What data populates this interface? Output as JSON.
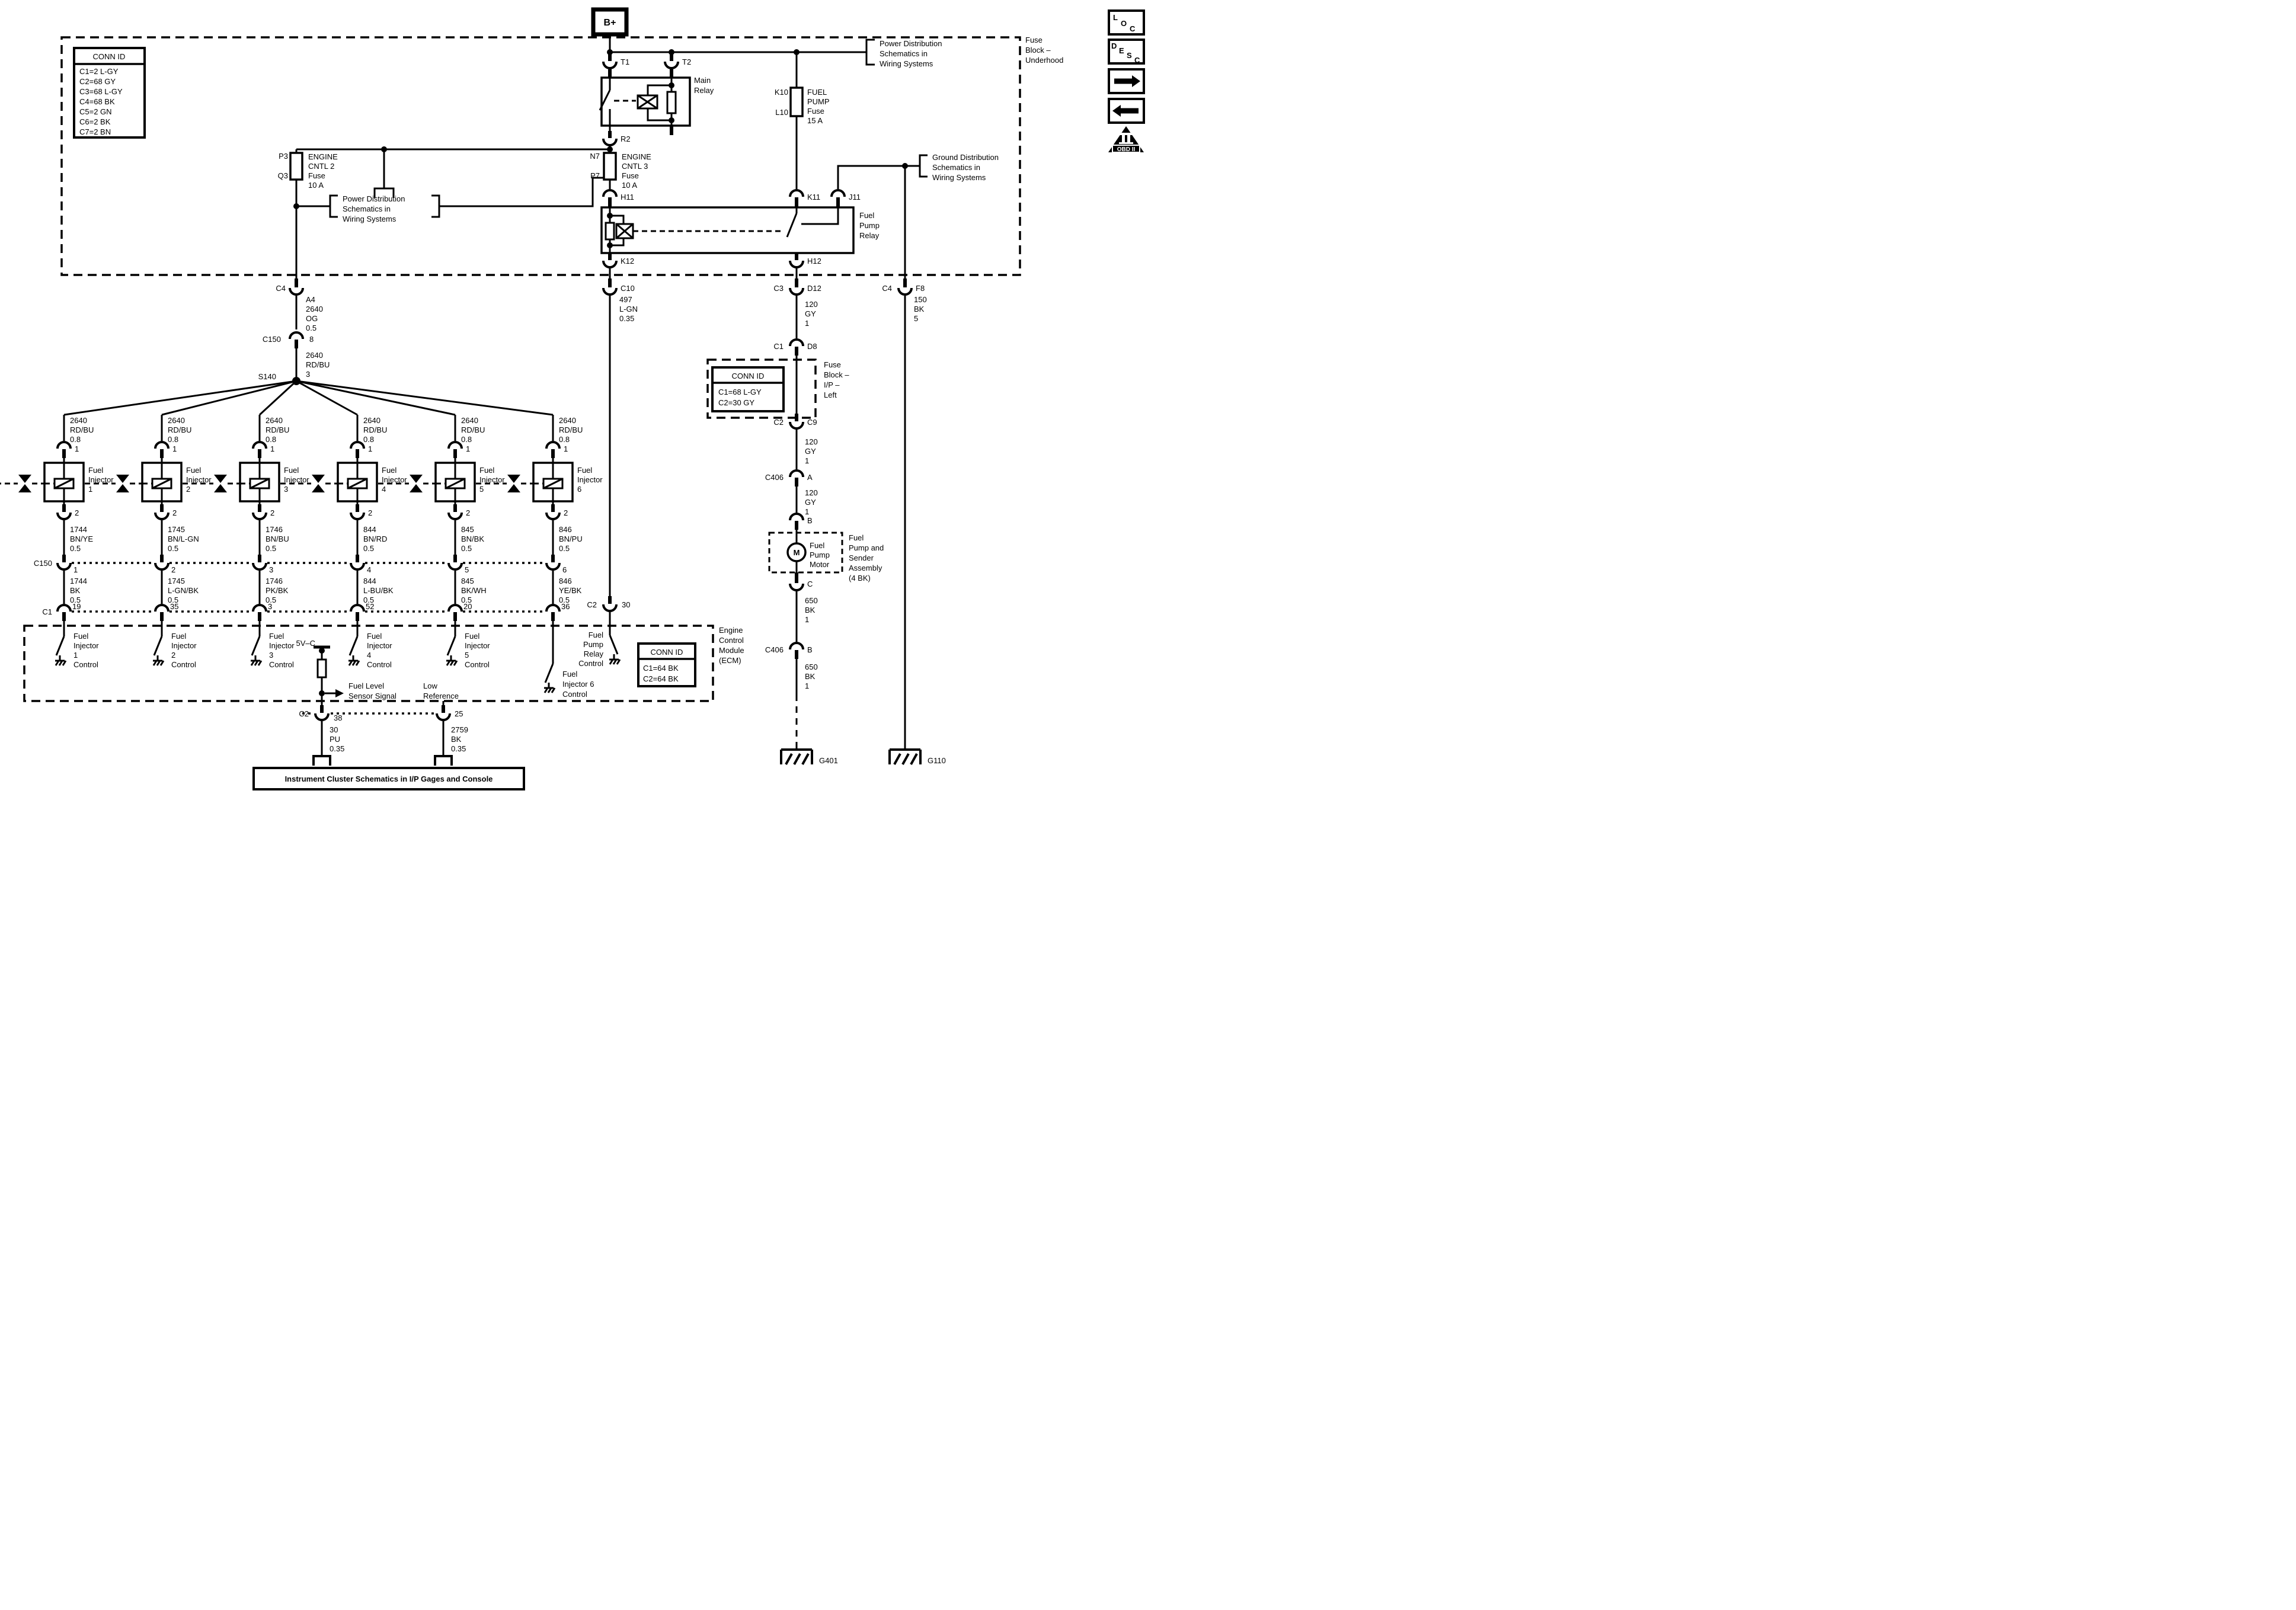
{
  "b_plus": "B+",
  "fuse_block_underhood": {
    "label_lines": [
      "Fuse",
      "Block –",
      "Underhood"
    ],
    "conn_id": {
      "title": "CONN ID",
      "rows": [
        "C1=2 L-GY",
        "C2=68 GY",
        "C3=68 L-GY",
        "C4=68 BK",
        "C5=2 GN",
        "C6=2 BK",
        "C7=2 BN"
      ]
    }
  },
  "links": {
    "power_dist_top": [
      "Power Distribution",
      "Schematics in",
      "Wiring Systems"
    ],
    "power_dist_mid": [
      "Power Distribution",
      "Schematics in",
      "Wiring Systems"
    ],
    "ground_dist": [
      "Ground Distribution",
      "Schematics in",
      "Wiring Systems"
    ],
    "instrument_cluster": "Instrument Cluster Schematics in I/P Gages and Console"
  },
  "main_relay": {
    "name_lines": [
      "Main",
      "Relay"
    ],
    "t1": "T1",
    "t2": "T2",
    "r2": "R2"
  },
  "fuses": {
    "engine_cntl_2": {
      "pin_top": "P3",
      "pin_bottom": "Q3",
      "label_lines": [
        "ENGINE",
        "CNTL 2",
        "Fuse",
        "10 A"
      ]
    },
    "engine_cntl_3": {
      "pin_top": "N7",
      "pin_bottom": "P7",
      "label_lines": [
        "ENGINE",
        "CNTL 3",
        "Fuse",
        "10 A"
      ]
    },
    "fuel_pump": {
      "pin_top": "K10",
      "pin_bottom": "L10",
      "label_lines": [
        "FUEL",
        "PUMP",
        "Fuse",
        "15 A"
      ]
    }
  },
  "fuel_pump_relay": {
    "name_lines": [
      "Fuel",
      "Pump",
      "Relay"
    ],
    "h11": "H11",
    "k11": "K11",
    "j11": "J11",
    "k12": "K12",
    "h12": "H12"
  },
  "connectors": {
    "c4_left": "C4",
    "c10": "C10",
    "c3": "C3",
    "d12": "D12",
    "c4_right": "C4",
    "f8": "F8",
    "c150_main": {
      "name": "C150",
      "pin": "8"
    },
    "s140": "S140",
    "c150_row": "C150",
    "c1_row": "C1",
    "c2_30": {
      "left": "C2",
      "right": "30"
    },
    "c2_38": {
      "left": "C2",
      "right": "38"
    },
    "pin_25": "25",
    "c1_d8": {
      "left": "C1",
      "right": "D8"
    },
    "c2_c9": {
      "left": "C2",
      "right": "C9"
    },
    "c406_a": {
      "left": "C406",
      "right": "A"
    },
    "pin_b_upper": "B",
    "pin_c": "C",
    "c406_b": {
      "left": "C406",
      "right": "B"
    }
  },
  "wires": {
    "a4_feed": [
      "A4",
      "2640",
      "OG",
      "0.5"
    ],
    "s140_feed": [
      "2640",
      "RD/BU",
      "3"
    ],
    "relay_control": [
      "497",
      "L-GN",
      "0.35"
    ],
    "pump_feed_1": [
      "120",
      "GY",
      "1"
    ],
    "pump_feed_2": [
      "120",
      "GY",
      "1"
    ],
    "pump_feed_3": [
      "120",
      "GY",
      "1"
    ],
    "right_ground": [
      "150",
      "BK",
      "5"
    ],
    "pump_ground_1": [
      "650",
      "BK",
      "1"
    ],
    "pump_ground_2": [
      "650",
      "BK",
      "1"
    ],
    "sensor_signal": [
      "30",
      "PU",
      "0.35"
    ],
    "low_ref_wire": [
      "2759",
      "BK",
      "0.35"
    ]
  },
  "injectors": [
    {
      "feed": [
        "2640",
        "RD/BU",
        "0.8"
      ],
      "pin_top": "1",
      "name": [
        "Fuel",
        "Injector",
        "1"
      ],
      "pin_bottom": "2",
      "out": [
        "1744",
        "BN/YE",
        "0.5"
      ],
      "c150_pin": "1",
      "below": [
        "1744",
        "BK",
        "0.5"
      ],
      "ecm_pin": "19"
    },
    {
      "feed": [
        "2640",
        "RD/BU",
        "0.8"
      ],
      "pin_top": "1",
      "name": [
        "Fuel",
        "Injector",
        "2"
      ],
      "pin_bottom": "2",
      "out": [
        "1745",
        "BN/L-GN",
        "0.5"
      ],
      "c150_pin": "2",
      "below": [
        "1745",
        "L-GN/BK",
        "0.5"
      ],
      "ecm_pin": "35"
    },
    {
      "feed": [
        "2640",
        "RD/BU",
        "0.8"
      ],
      "pin_top": "1",
      "name": [
        "Fuel",
        "Injector",
        "3"
      ],
      "pin_bottom": "2",
      "out": [
        "1746",
        "BN/BU",
        "0.5"
      ],
      "c150_pin": "3",
      "below": [
        "1746",
        "PK/BK",
        "0.5"
      ],
      "ecm_pin": "3"
    },
    {
      "feed": [
        "2640",
        "RD/BU",
        "0.8"
      ],
      "pin_top": "1",
      "name": [
        "Fuel",
        "Injector",
        "4"
      ],
      "pin_bottom": "2",
      "out": [
        "844",
        "BN/RD",
        "0.5"
      ],
      "c150_pin": "4",
      "below": [
        "844",
        "L-BU/BK",
        "0.5"
      ],
      "ecm_pin": "52"
    },
    {
      "feed": [
        "2640",
        "RD/BU",
        "0.8"
      ],
      "pin_top": "1",
      "name": [
        "Fuel",
        "Injector",
        "5"
      ],
      "pin_bottom": "2",
      "out": [
        "845",
        "BN/BK",
        "0.5"
      ],
      "c150_pin": "5",
      "below": [
        "845",
        "BK/WH",
        "0.5"
      ],
      "ecm_pin": "20"
    },
    {
      "feed": [
        "2640",
        "RD/BU",
        "0.8"
      ],
      "pin_top": "1",
      "name": [
        "Fuel",
        "Injector",
        "6"
      ],
      "pin_bottom": "2",
      "out": [
        "846",
        "BN/PU",
        "0.5"
      ],
      "c150_pin": "6",
      "below": [
        "846",
        "YE/BK",
        "0.5"
      ],
      "ecm_pin": "36"
    }
  ],
  "controls": [
    {
      "lines": [
        "Fuel",
        "Injector",
        "1",
        "Control"
      ]
    },
    {
      "lines": [
        "Fuel",
        "Injector",
        "2",
        "Control"
      ]
    },
    {
      "lines": [
        "Fuel",
        "Injector",
        "3",
        "Control"
      ]
    },
    {
      "lines": [
        "Fuel",
        "Injector",
        "4",
        "Control"
      ]
    },
    {
      "lines": [
        "Fuel",
        "Injector",
        "5",
        "Control"
      ]
    }
  ],
  "ecm": {
    "name_lines": [
      "Engine",
      "Control",
      "Module",
      "(ECM)"
    ],
    "conn_id": {
      "title": "CONN ID",
      "rows": [
        "C1=64 BK",
        "C2=64 BK"
      ]
    },
    "five_v": "5V–C",
    "fuel_level": [
      "Fuel Level",
      "Sensor Signal"
    ],
    "low_reference": [
      "Low",
      "Reference"
    ],
    "pump_relay_control": [
      "Fuel",
      "Pump",
      "Relay",
      "Control"
    ],
    "inj6_control": [
      "Fuel",
      "Injector 6",
      "Control"
    ]
  },
  "fuse_block_ip": {
    "label_lines": [
      "Fuse",
      "Block –",
      "I/P –",
      "Left"
    ],
    "conn_id": {
      "title": "CONN ID",
      "rows": [
        "C1=68 L-GY",
        "C2=30 GY"
      ]
    }
  },
  "fuel_pump_assembly": {
    "motor_letter": "M",
    "motor_lines": [
      "Fuel",
      "Pump",
      "Motor"
    ],
    "assembly_lines": [
      "Fuel",
      "Pump and",
      "Sender",
      "Assembly",
      "(4 BK)"
    ]
  },
  "grounds": {
    "g401": "G401",
    "g110": "G110"
  },
  "sidebar_icons": {
    "loc": [
      "L",
      "O",
      "C"
    ],
    "desc": [
      "D",
      "E",
      "S",
      "C"
    ],
    "obd": "OBD II"
  }
}
